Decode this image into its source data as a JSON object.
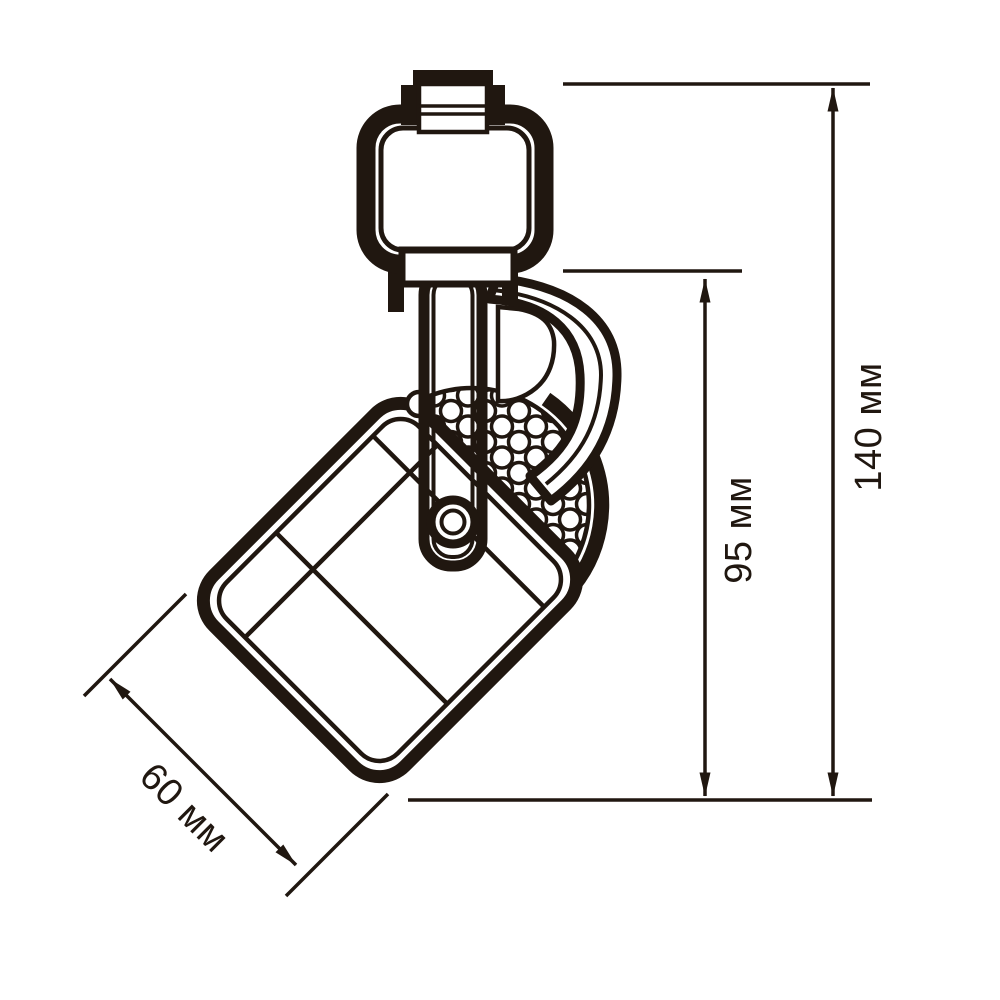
{
  "canvas": {
    "background": "#ffffff",
    "ink_color": "#201710"
  },
  "drawing": {
    "type": "technical-dimension-drawing",
    "subject": "track-spotlight-side-view",
    "dimensions": [
      {
        "id": "overall-height",
        "label": "140 мм"
      },
      {
        "id": "arm-section-height",
        "label": "95 мм"
      },
      {
        "id": "head-width",
        "label": "60 мм"
      }
    ]
  }
}
